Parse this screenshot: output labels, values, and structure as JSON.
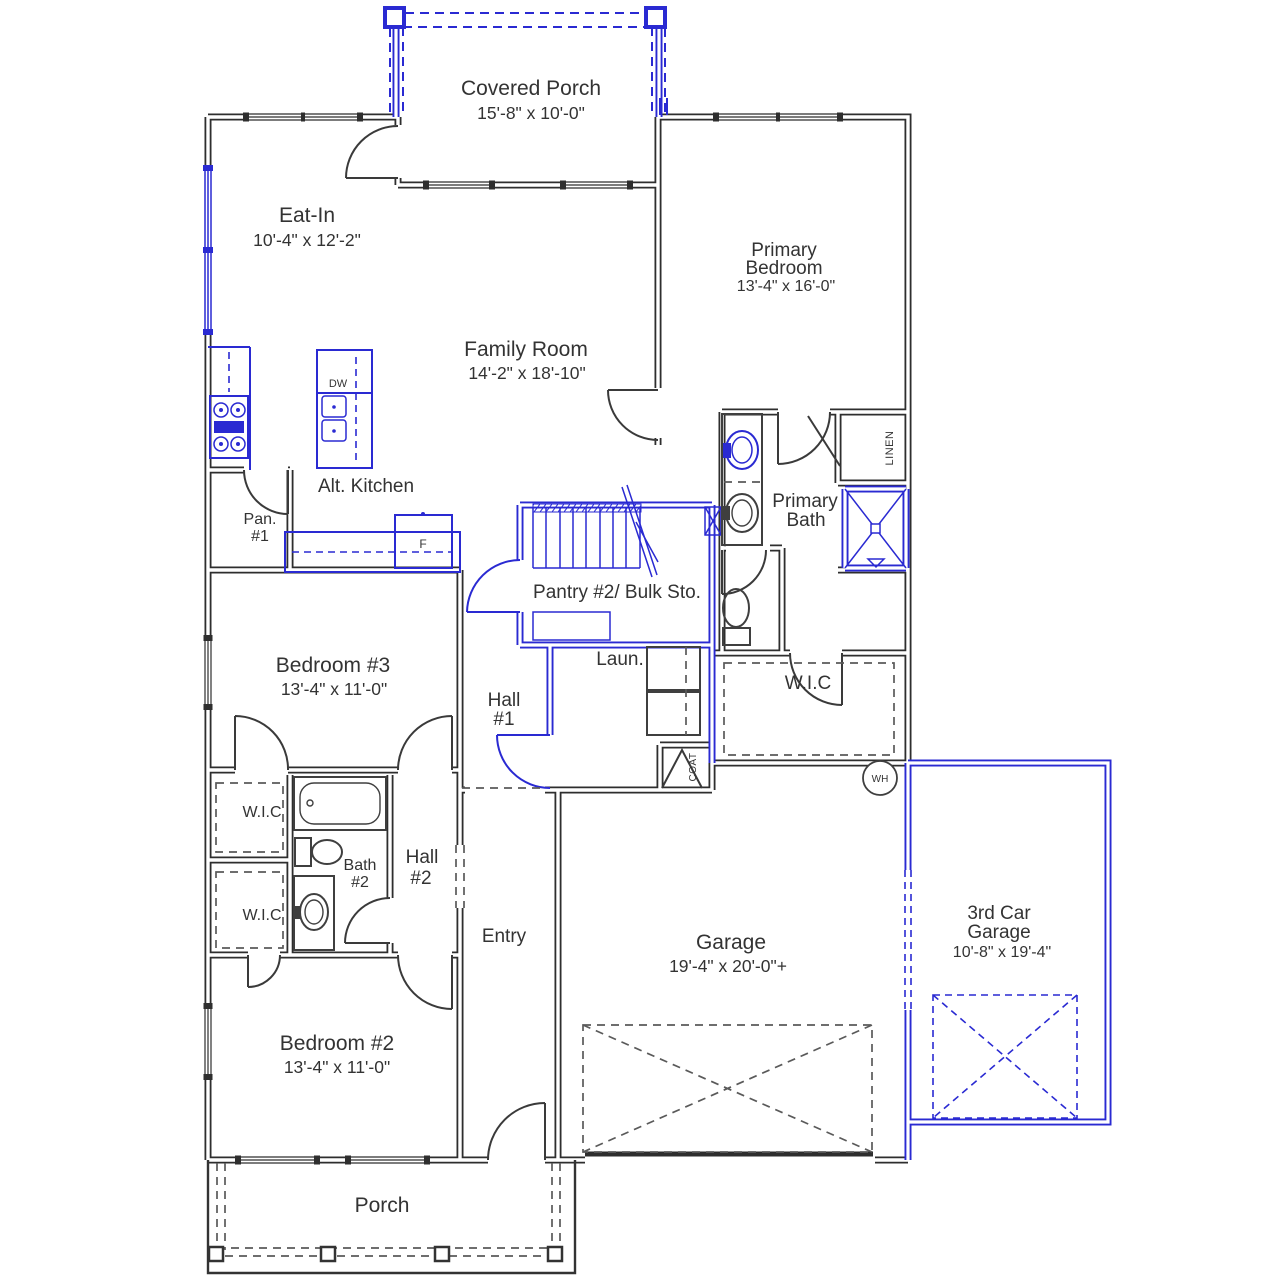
{
  "meta": {
    "drawing_type": "Single-story house floor plan"
  },
  "colors": {
    "wall": "#2e2e2e",
    "blue": "#2a2ad2",
    "text": "#333333",
    "dash": "#5a5a5a",
    "bg": "#ffffff"
  },
  "rooms": {
    "covered_porch": {
      "label": "Covered Porch",
      "dims": "15'-8\" x 10'-0\""
    },
    "eat_in": {
      "label": "Eat-In",
      "dims": "10'-4\" x 12'-2\""
    },
    "primary_bedroom": {
      "label_line1": "Primary",
      "label_line2": "Bedroom",
      "dims": "13'-4\" x 16'-0\""
    },
    "family_room": {
      "label": "Family Room",
      "dims": "14'-2\" x 18'-10\""
    },
    "alt_kitchen": {
      "label": "Alt. Kitchen"
    },
    "pantry1": {
      "label_line1": "Pan.",
      "label_line2": "#1"
    },
    "primary_bath": {
      "label_line1": "Primary",
      "label_line2": "Bath"
    },
    "pantry2": {
      "label": "Pantry #2/ Bulk Sto."
    },
    "laundry": {
      "label": "Laun."
    },
    "primary_wic": {
      "label": "W.I.C"
    },
    "hall1": {
      "label_line1": "Hall",
      "label_line2": "#1"
    },
    "bedroom3": {
      "label": "Bedroom #3",
      "dims": "13'-4\" x 11'-0\""
    },
    "wic1": {
      "label": "W.I.C"
    },
    "wic2": {
      "label": "W.I.C"
    },
    "bath2": {
      "label_line1": "Bath",
      "label_line2": "#2"
    },
    "hall2": {
      "label_line1": "Hall",
      "label_line2": "#2"
    },
    "entry": {
      "label": "Entry"
    },
    "garage": {
      "label": "Garage",
      "dims": "19'-4\" x 20'-0\"+"
    },
    "third_car_garage": {
      "label_line1": "3rd Car",
      "label_line2": "Garage",
      "dims": "10'-8\" x 19'-4\""
    },
    "bedroom2": {
      "label": "Bedroom #2",
      "dims": "13'-4\" x 11'-0\""
    },
    "porch": {
      "label": "Porch"
    }
  },
  "fixtures": {
    "dishwasher": "DW",
    "fridge": "F",
    "linen": "LINEN",
    "coat": "COAT",
    "water_heater": "WH"
  }
}
